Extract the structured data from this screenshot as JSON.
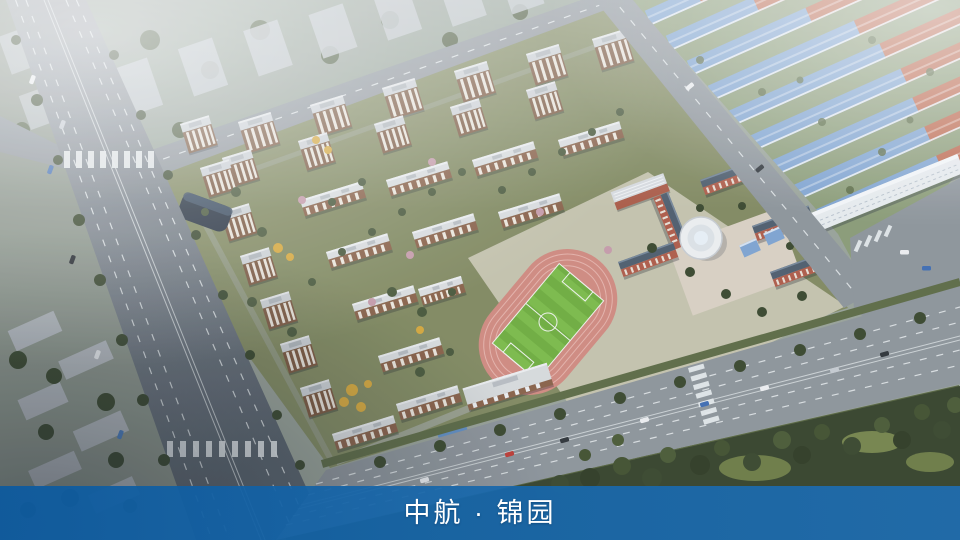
{
  "banner": {
    "title": "中航 · 锦园",
    "background_color": "#1166a8",
    "text_color": "#ffffff"
  },
  "scene": {
    "type": "aerial-masterplan-render",
    "elements": [
      "residential-towers",
      "residential-slab-buildings",
      "entrance-glass-building",
      "commercial-street-building",
      "school-campus",
      "running-track",
      "soccer-field",
      "rotunda-building",
      "townhouse-rows-blue-roof",
      "townhouse-rows-red-roof",
      "arterial-roads",
      "forest-parkland",
      "hazy-context-city"
    ],
    "colors": {
      "banner_blue": "#1166a8",
      "track_pink": "#d28b80",
      "field_green": "#6fae3e",
      "blue_roof": "#7fa4d2",
      "red_roof": "#bf664a",
      "school_brick": "#b05b48",
      "residential_wall": "#8a6148",
      "residential_roof": "#dcdfe1",
      "forest_green": "#36422a",
      "road_gray": "#8e959b"
    }
  }
}
